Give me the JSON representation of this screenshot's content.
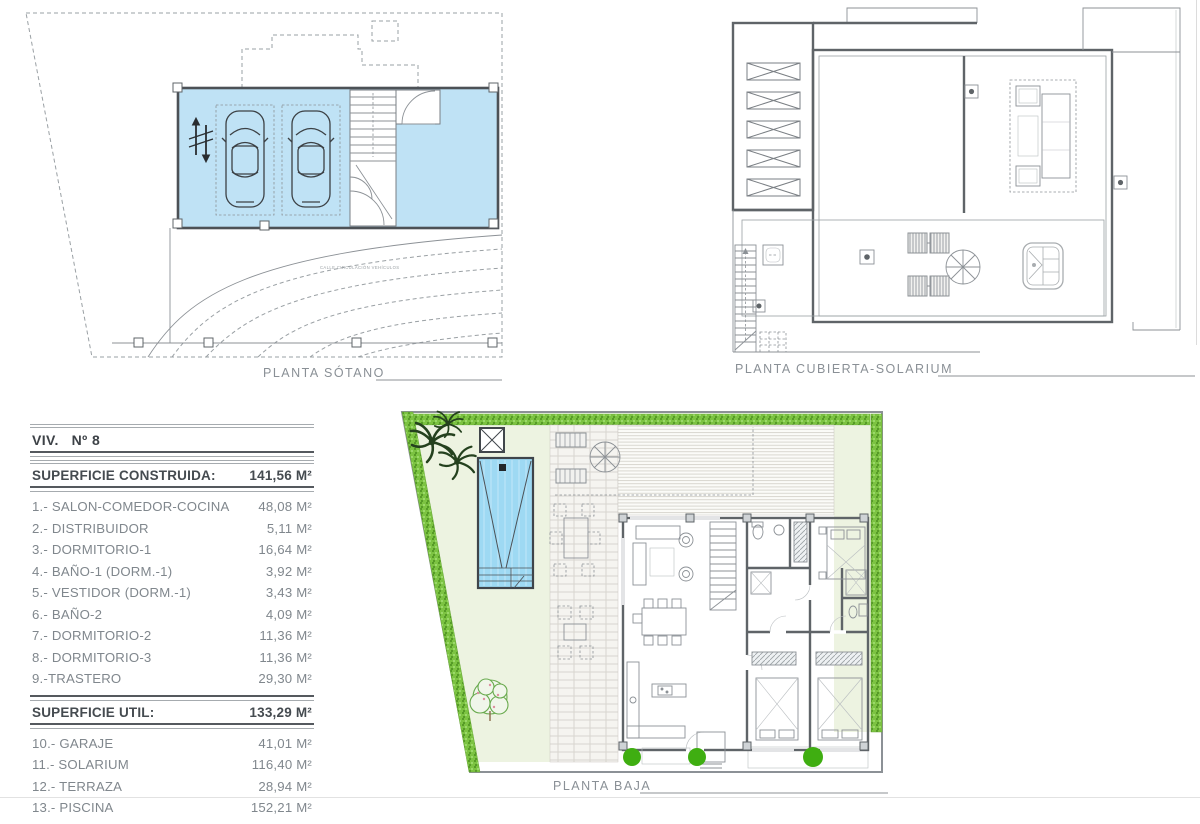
{
  "plans": {
    "sotano": {
      "label": "PLANTA SÓTANO",
      "road_label": "CALLE CIRCULACIÓN VEHÍCULOS"
    },
    "cubierta": {
      "label": "PLANTA CUBIERTA-SOLARIUM"
    },
    "baja": {
      "label": "PLANTA BAJA"
    }
  },
  "table": {
    "title": "VIV.   Nº 8",
    "constructed": {
      "label": "SUPERFICIE CONSTRUIDA:",
      "value": "141,56 M²"
    },
    "rooms": [
      {
        "label": "1.- SALON-COMEDOR-COCINA",
        "value": "48,08 M²"
      },
      {
        "label": "2.- DISTRIBUIDOR",
        "value": "5,11 M²"
      },
      {
        "label": "3.- DORMITORIO-1",
        "value": "16,64 M²"
      },
      {
        "label": "4.- BAÑO-1 (DORM.-1)",
        "value": "3,92 M²"
      },
      {
        "label": "5.- VESTIDOR (DORM.-1)",
        "value": "3,43 M²"
      },
      {
        "label": "6.- BAÑO-2",
        "value": "4,09 M²"
      },
      {
        "label": "7.- DORMITORIO-2",
        "value": "11,36 M²"
      },
      {
        "label": "8.- DORMITORIO-3",
        "value": "11,36 M²"
      },
      {
        "label": "9.-TRASTERO",
        "value": "29,30 M²"
      }
    ],
    "useful": {
      "label": "SUPERFICIE UTIL:",
      "value": "133,29 M²"
    },
    "exterior": [
      {
        "label": "10.- GARAJE",
        "value": "41,01 M²"
      },
      {
        "label": "11.- SOLARIUM",
        "value": "116,40 M²"
      },
      {
        "label": "12.- TERRAZA",
        "value": "28,94 M²"
      },
      {
        "label": "13.- PISCINA",
        "value": "152,21 M²"
      }
    ]
  },
  "colors": {
    "garage-blue": "#bfe2f5",
    "pool-blue": "#9ed9f3",
    "hedge-green": "#7cc342",
    "hedge-dark": "#569b27",
    "lawn-green": "#edf3e1",
    "bush-green": "#3fae11",
    "tree-green": "#69aa4e",
    "palm-green": "#24411e"
  }
}
